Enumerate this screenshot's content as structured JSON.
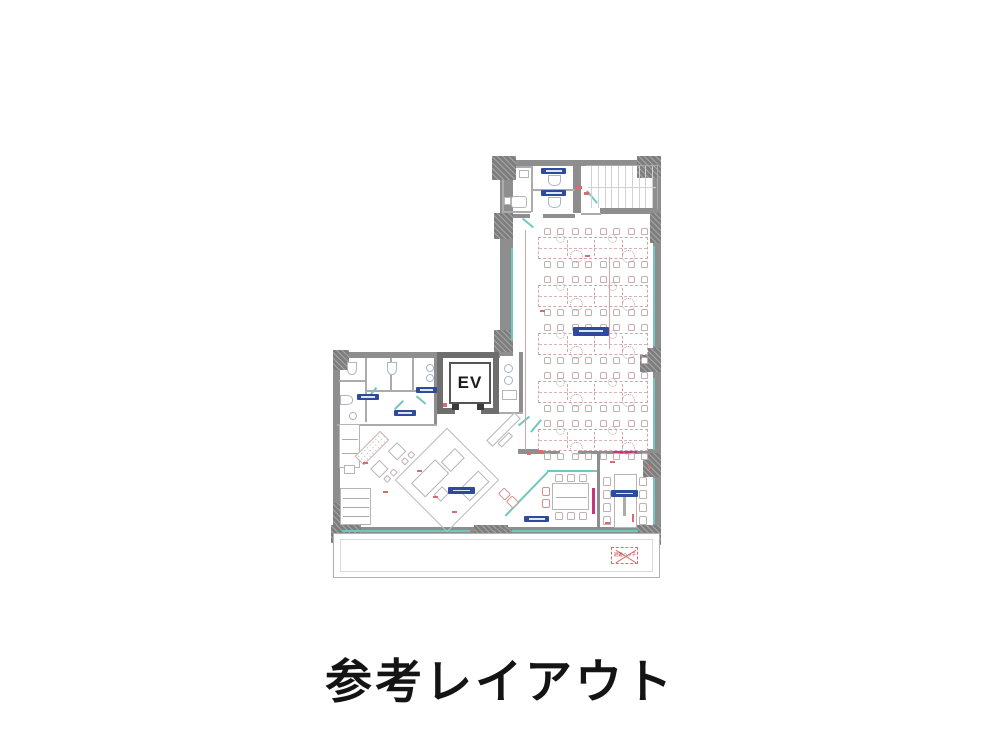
{
  "title": {
    "text": "参考レイアウト"
  },
  "floorplan": {
    "elevator": {
      "label": "EV"
    },
    "stairs": {
      "treads": 10
    },
    "office": {
      "desk_bands": 5,
      "desk_columns": 4,
      "chairs_per_row": 8,
      "band_pitch_px": 48
    },
    "meeting_room_small": {
      "chairs_top": 3,
      "chairs_bottom": 3,
      "side_chairs": 2
    },
    "meeting_room_long": {
      "chairs_per_side": 4
    },
    "balcony": {
      "evac_hatch_text": "避難ハッチ"
    },
    "room_label_chips": [
      {
        "id": "wc-stall-north-1",
        "text": ""
      },
      {
        "id": "wc-stall-north-2",
        "text": ""
      },
      {
        "id": "office-area",
        "text": ""
      },
      {
        "id": "powder-room",
        "text": ""
      },
      {
        "id": "wc-west",
        "text": ""
      },
      {
        "id": "utility-room",
        "text": ""
      },
      {
        "id": "lounge",
        "text": ""
      },
      {
        "id": "meeting-room-small",
        "text": ""
      },
      {
        "id": "meeting-room-long",
        "text": ""
      }
    ],
    "colors": {
      "wall": "#8e8e8e",
      "column": "#7e7e7e",
      "elevator_wall": "#6e6e6e",
      "window_glass": "#6fc7bf",
      "label_chip": "#2e4a9e",
      "dimension_red": "#d96c6c",
      "accent_magenta": "#c8357f",
      "furniture_line": "#c0b1b1",
      "title_text": "#141414"
    }
  }
}
